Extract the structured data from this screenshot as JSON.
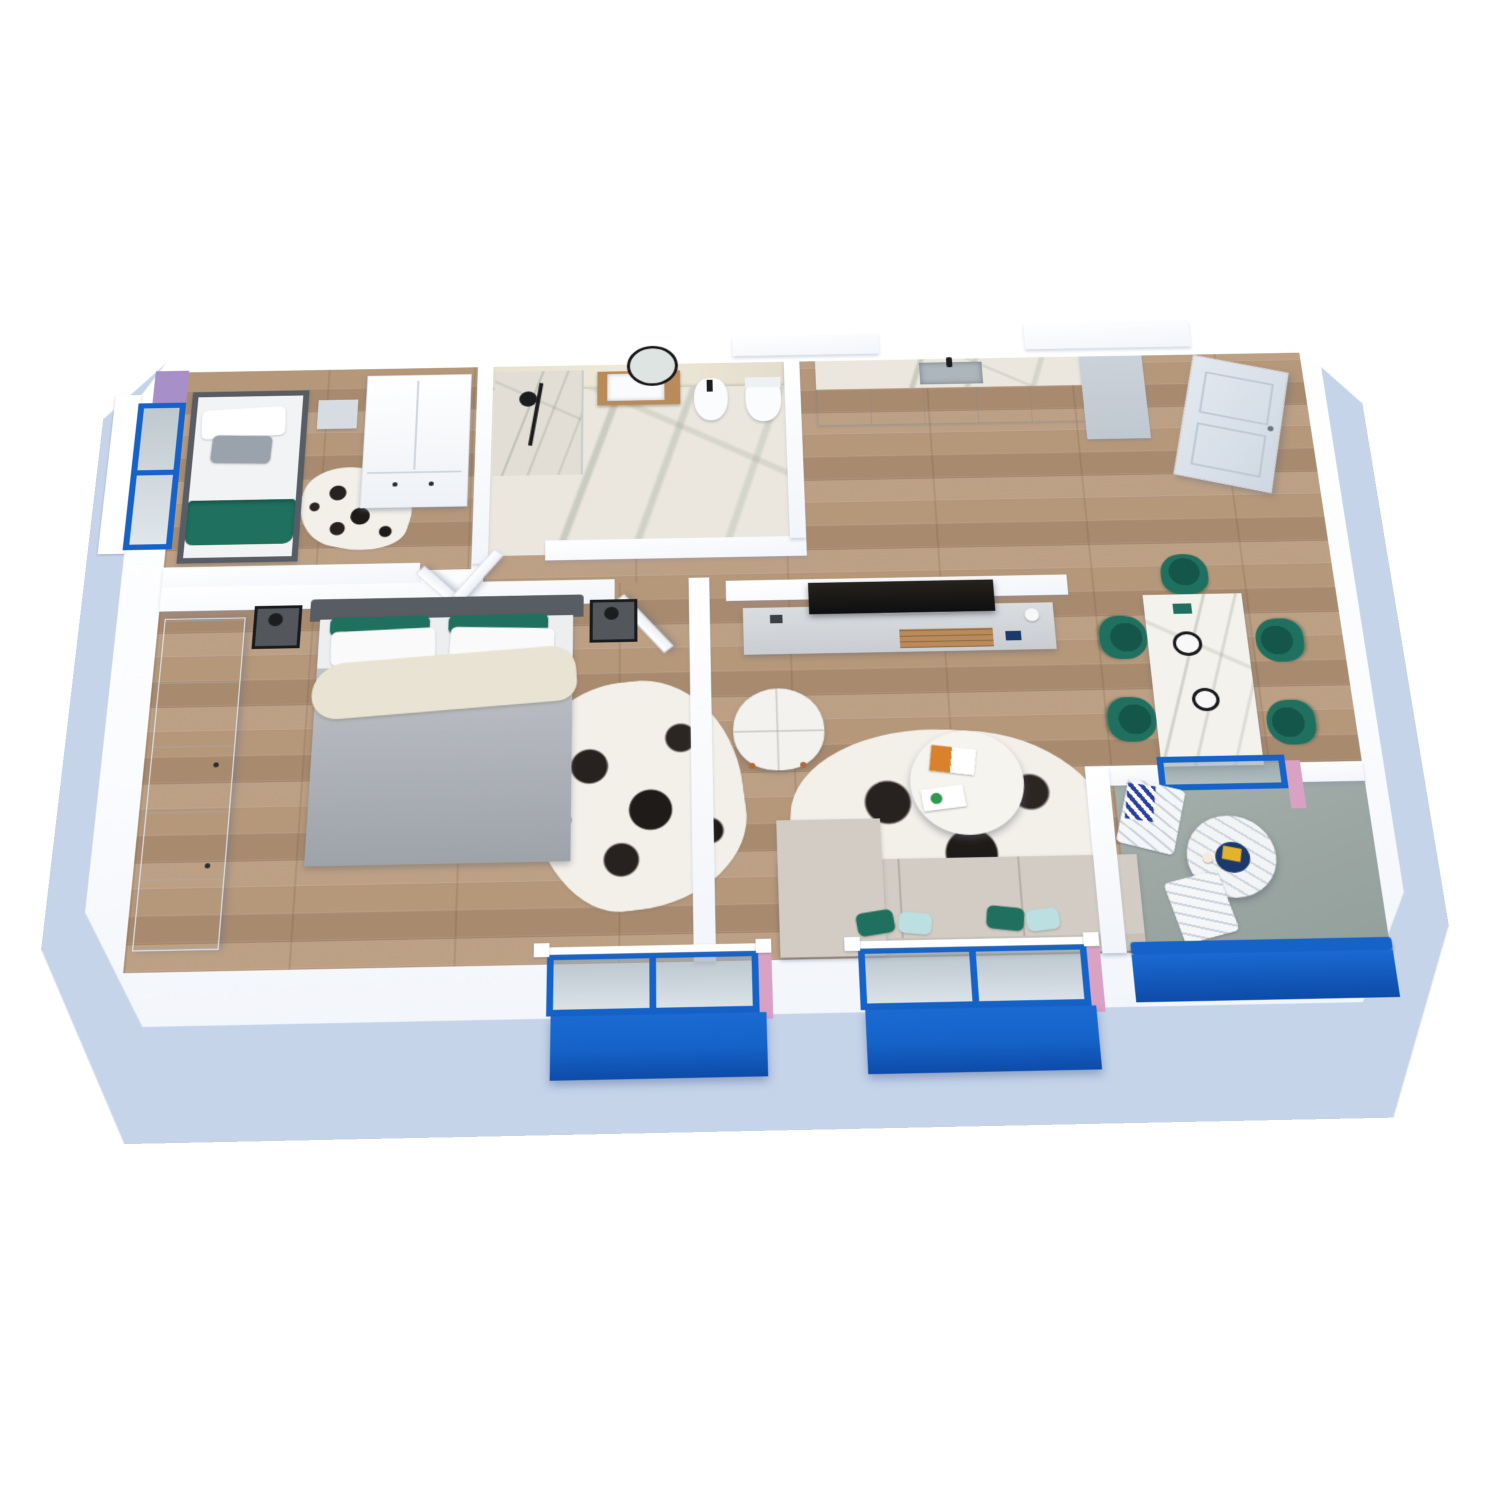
{
  "scene": {
    "kind": "isometric-3d-floor-plan-render",
    "view": "top-down-perspective",
    "background": "white",
    "text_labels": []
  },
  "palette": {
    "facade_blue": "#c6d4ea",
    "wall_white": "#ffffff",
    "accent_blue": "#1563c9",
    "accent_blue_dark": "#0d4ba8",
    "glass_gray": "#9fb2b8",
    "lavender": "#a78fc7",
    "pink": "#d9a2c4",
    "wood": "#b5977a",
    "marble": "#ebe7df",
    "loggia_floor": "#9ba6a2",
    "teal": "#20705f",
    "teal_dark": "#15564a",
    "mint": "#bcdfe2",
    "sofa_beige": "#d2ccc4",
    "gray_fabric": "#a8adb4",
    "dark_frame": "#585d63",
    "metal_black": "#1c1d1f",
    "cream": "#e9e3d3",
    "navy": "#1b3a6b",
    "yellow": "#e5b22e",
    "wood_accent": "#b98a5a"
  },
  "rooms": {
    "small_bedroom": {
      "furniture": [
        "single-bed",
        "white-pillow",
        "gray-cushion",
        "teal-blanket",
        "nightstand",
        "wardrobe",
        "cowhide-rug",
        "blue-frame-window",
        "lavender-accent-panel"
      ]
    },
    "master_bedroom": {
      "furniture": [
        "double-bed",
        "gray-headboard",
        "teal-pillows",
        "white-pillows",
        "gray-duvet",
        "cream-throw",
        "metal-nightstand-left",
        "metal-nightstand-right",
        "black-lamps",
        "wardrobe",
        "cowhide-rug",
        "balcony-window",
        "door"
      ]
    },
    "bathroom": {
      "furniture": [
        "shower-black-column",
        "round-mirror",
        "vanity-sink",
        "bidet",
        "toilet",
        "marble-walls",
        "door"
      ]
    },
    "living_room": {
      "furniture": [
        "tv",
        "tv-console",
        "white-armchair",
        "round-coffee-table",
        "magazines",
        "cowhide-rug",
        "beige-sofa",
        "teal-pillows",
        "mint-pillows",
        "balcony-window"
      ]
    },
    "kitchen_dining": {
      "furniture": [
        "kitchen-cabinets",
        "sink-black-faucet",
        "tall-cabinet",
        "entrance-door",
        "marble-dining-table",
        "teal-chairs",
        "plates"
      ]
    },
    "loggia_balcony": {
      "furniture": [
        "round-slat-table",
        "navy-tray",
        "yellow-book",
        "slat-chairs",
        "chevron-towel",
        "blue-parapet",
        "sliding-door",
        "pink-reveal"
      ]
    }
  }
}
